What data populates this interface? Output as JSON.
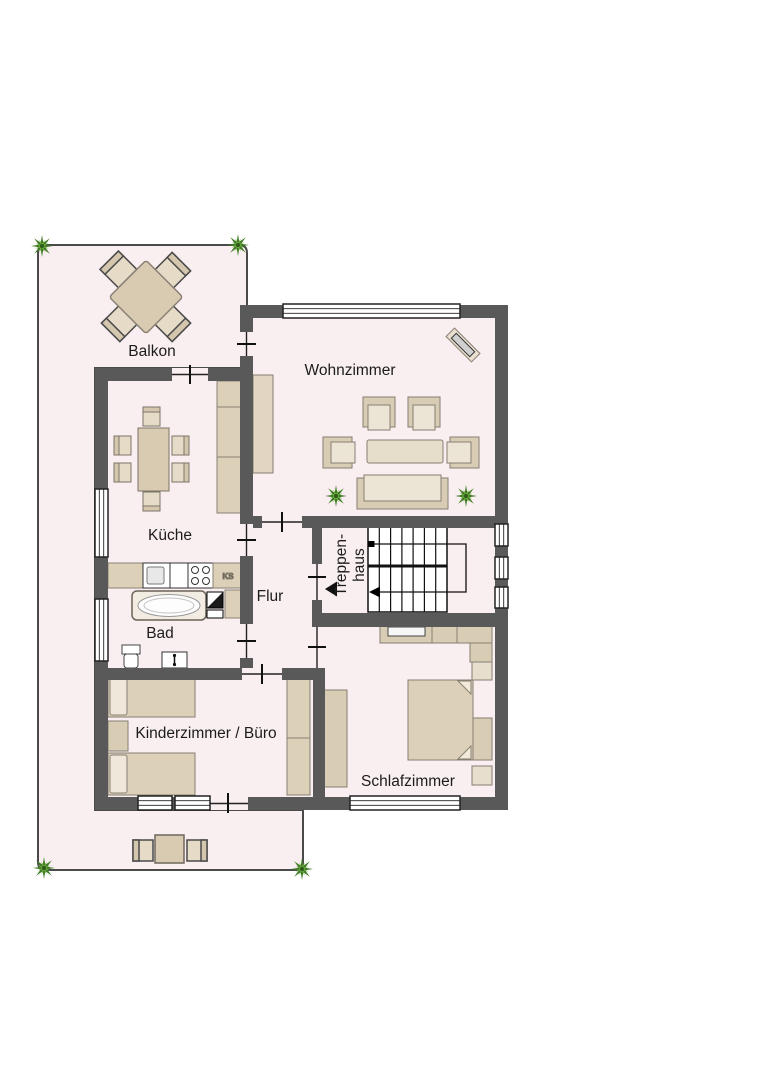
{
  "floorplan": {
    "rooms": {
      "balkon": "Balkon",
      "wohnzimmer": "Wohnzimmer",
      "kueche": "Küche",
      "flur": "Flur",
      "treppenhaus": {
        "line1": "Treppen-",
        "line2": "haus"
      },
      "bad": "Bad",
      "kinderzimmer_buero": "Kinderzimmer / Büro",
      "schlafzimmer": "Schlafzimmer"
    },
    "appliances": {
      "kuehlschrank_abbr": "KS"
    },
    "colors": {
      "wall": "#595959",
      "interior_floor": "#f9eef0",
      "terrace": "#f9eef0",
      "furniture_fill": "#ddd0b8",
      "furniture_light": "#ece4d5",
      "furniture_border": "#877f72",
      "plant_dark": "#3f7d23",
      "plant_light": "#6fa844",
      "outline": "#1c1c1c"
    }
  }
}
